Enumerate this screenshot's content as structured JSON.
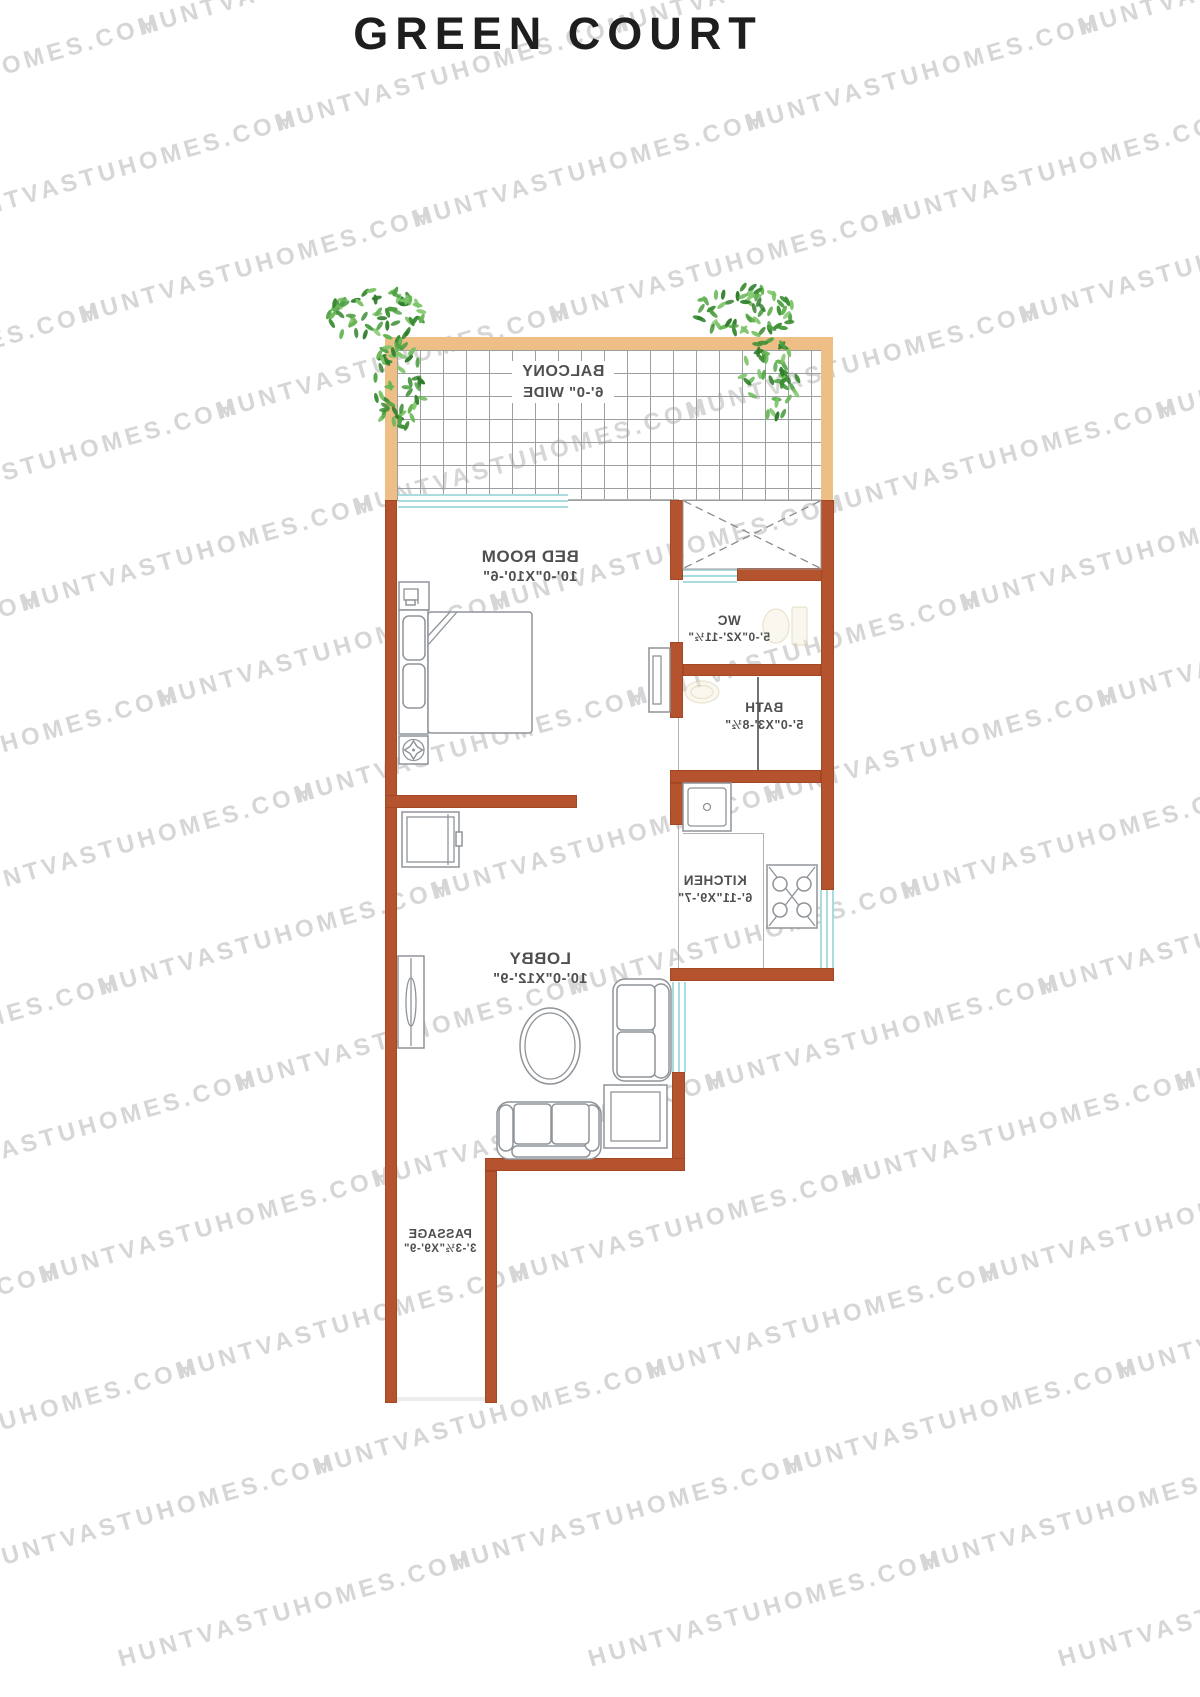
{
  "title": "GREEN COURT",
  "watermark": {
    "text": "HUNTVASTUHOMES.COM"
  },
  "colors": {
    "wall": "#b5532e",
    "balcony_wall": "#edbe85",
    "window": "#aadcdf",
    "grid_line": "#9aa0a0",
    "furniture_line": "#8f9499",
    "label_text": "#4f4f4f",
    "watermark_text": "#d6d6d6",
    "title_text": "#1e1e1e",
    "plant_green": "#4ea144"
  },
  "rooms": {
    "balcony": {
      "label": "BALCONY",
      "dims": "6'-0\" WIDE"
    },
    "bedroom": {
      "label": "BED ROOM",
      "dims": "10'-0\"X10'-6\""
    },
    "wc": {
      "label": "WC",
      "dims": "5'-0\"X2'-11½\""
    },
    "bath": {
      "label": "BATH",
      "dims": "5'-0\"X3'-8½\""
    },
    "kitchen": {
      "label": "KITCHEN",
      "dims": "6'-11\"X9'-7\""
    },
    "lobby": {
      "label": "LOBBY",
      "dims": "10'-0\"X12'-9\""
    },
    "passage": {
      "label": "PASSAGE",
      "dims": "3'-3½\"X9'-9\""
    }
  }
}
